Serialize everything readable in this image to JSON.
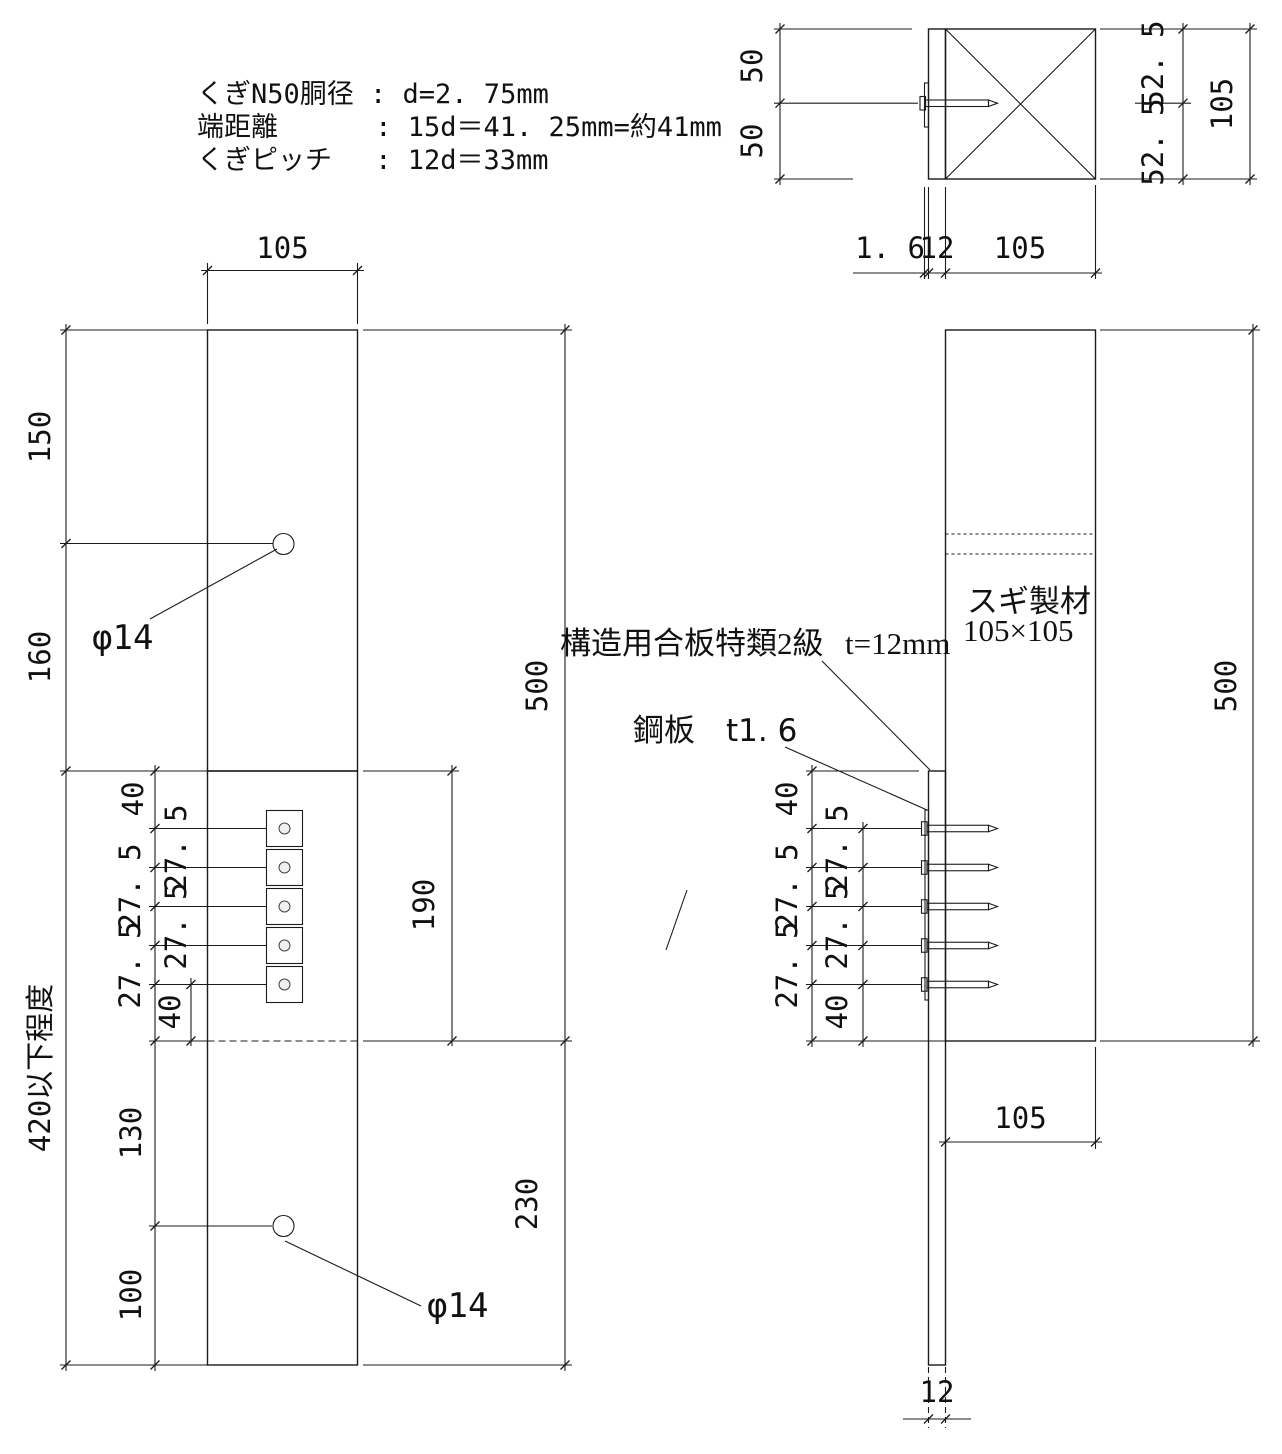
{
  "notes": {
    "lines": [
      "くぎN50胴径 : d=2. 75mm",
      "端距離　　　 : 15d＝41. 25mm=約41mm",
      "くぎピッチ　 : 12d＝33mm"
    ]
  },
  "plan_view": {
    "dim_left_top": "50",
    "dim_left_bottom": "50",
    "dim_right_inner_top": "52. 5",
    "dim_right_inner_bottom": "52. 5",
    "dim_right_outer": "105",
    "dim_bottom_plate": "1. 6",
    "dim_bottom_plywood": "12",
    "dim_bottom_post": "105"
  },
  "front_view": {
    "dim_width_top": "105",
    "dim_150": "150",
    "dim_160": "160",
    "dim_420": "420以下程度",
    "dim_40_top": "40",
    "dim_pitch": [
      "27. 5",
      "27. 5",
      "27. 5",
      "27. 5"
    ],
    "dim_40_bottom": "40",
    "dim_130": "130",
    "dim_100": "100",
    "dim_190": "190",
    "dim_500": "500",
    "dim_230": "230",
    "hole_top": "φ14",
    "hole_bottom": "φ14"
  },
  "side_view": {
    "dim_40_top": "40",
    "dim_pitch": [
      "27. 5",
      "27. 5",
      "27. 5",
      "27. 5"
    ],
    "dim_40_bottom": "40",
    "dim_500": "500",
    "dim_105_bottom": "105",
    "dim_12_bottom": "12",
    "post_label_line1": "スギ製材",
    "post_label_line2": "105×105",
    "plywood_label": "構造用合板特類2級",
    "plywood_thickness": "t=12mm",
    "steel_label": "鋼板　t1. 6"
  },
  "colors": {
    "wood_light": "#EBE4C3",
    "wood_dark": "#D6C88E",
    "hole_fill": "#EDEDEA",
    "plate_fill": "#FFFFFF",
    "line": "#1B1B1B"
  }
}
